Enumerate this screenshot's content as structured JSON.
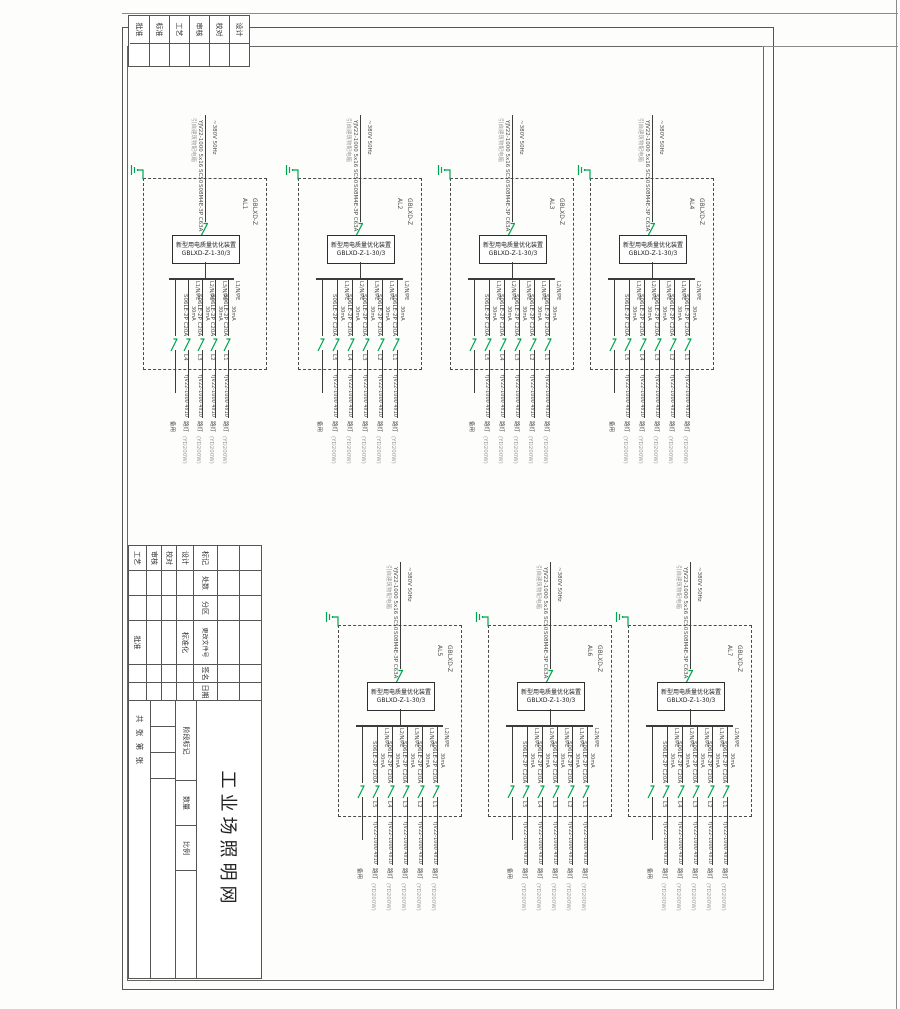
{
  "sheet": {
    "title": "工业场照明网",
    "corner_labels": [
      "设计",
      "校对",
      "审核",
      "工艺",
      "标准",
      "批准"
    ],
    "rev_headers": [
      "标记",
      "处数",
      "分区",
      "更改文件号",
      "签名",
      "日期"
    ],
    "sig_labels": [
      "设计",
      "校对",
      "审核",
      "工艺"
    ],
    "std_label": "标准化",
    "approve_label": "批准",
    "stage_label": "阶段标记",
    "qty_label": "数量",
    "scale_label": "比例",
    "sheet_count": "共 张 第 张"
  },
  "shared": {
    "incoming_source": "引自建筑物配电箱",
    "incoming_cable": "YJV22-1000 5x16 SC50",
    "incoming_voltage": "~380V 50Hz",
    "main_breaker": "S08M4E-3P C63A",
    "device_name": "新型用电质量优化装置",
    "device_model": "GBLXD-Z-1-30/3",
    "panel_model": "GBLXD-Z",
    "branch_breaker": "S06LE-2P C20A",
    "branch_rcd": "30mA",
    "branch_cable": "YJV22-1000 4x10",
    "load_name": "路灯",
    "load_power": "(YD200W)",
    "spare_label": "备用",
    "phase_labels": [
      "L1/N/PE",
      "L2/N/PE",
      "L3/N/PE"
    ]
  },
  "blocks": [
    {
      "panel": "AL1",
      "circuits": [
        "L4",
        "L3",
        "L2",
        "L1"
      ]
    },
    {
      "panel": "AL2",
      "circuits": [
        "L5",
        "L4",
        "L3",
        "L2",
        "L1"
      ]
    },
    {
      "panel": "AL3",
      "circuits": [
        "L5",
        "L4",
        "L3",
        "L2",
        "L1"
      ]
    },
    {
      "panel": "AL4",
      "circuits": [
        "L5",
        "L4",
        "L3",
        "L2",
        "L1"
      ]
    },
    {
      "panel": "AL5",
      "circuits": [
        "L5",
        "L4",
        "L3",
        "L2",
        "L1"
      ]
    },
    {
      "panel": "AL6",
      "circuits": [
        "L5",
        "L4",
        "L3",
        "L2",
        "L1"
      ]
    },
    {
      "panel": "AL7",
      "circuits": [
        "L5",
        "L4",
        "L3",
        "L2",
        "L1"
      ]
    }
  ]
}
